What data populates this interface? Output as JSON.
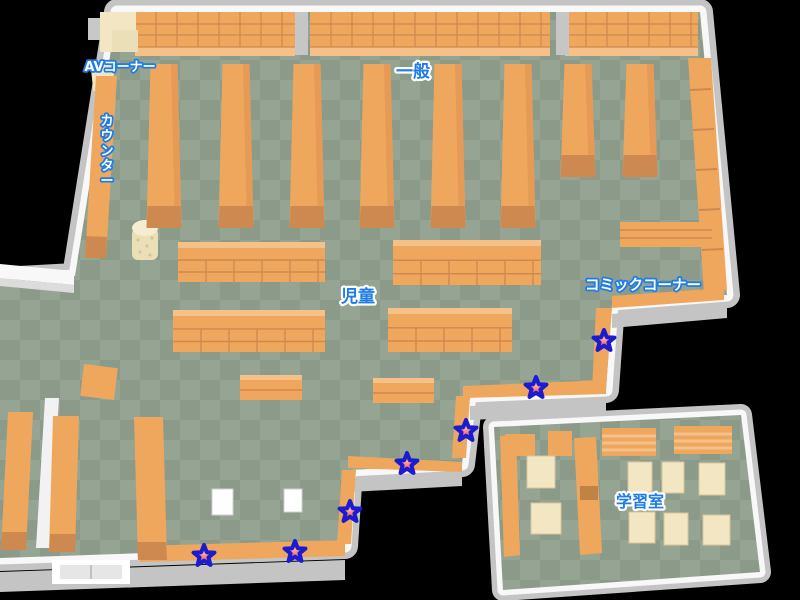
{
  "map": {
    "areas": {
      "av_corner": {
        "label": "AVコーナー"
      },
      "counter": {
        "label": "カウンター"
      },
      "general": {
        "label": "一般"
      },
      "children": {
        "label": "児童"
      },
      "comic_corner": {
        "label": "コミックコーナー"
      },
      "study_room": {
        "label": "学習室"
      }
    },
    "markers": [
      {
        "x": 604,
        "y": 341
      },
      {
        "x": 536,
        "y": 388
      },
      {
        "x": 466,
        "y": 431
      },
      {
        "x": 407,
        "y": 464
      },
      {
        "x": 350,
        "y": 512
      },
      {
        "x": 295,
        "y": 552
      },
      {
        "x": 204,
        "y": 556
      }
    ],
    "colors": {
      "floor_dark": "#8c9a8a",
      "floor_light": "#96a493",
      "shelf": "#efa75e",
      "shelf_dark": "#cd8950",
      "shelf_light": "#f6c189",
      "cream": "#f3e6c2",
      "wall": "#f8f8f8",
      "wall_shadow": "#c4c4c4",
      "label_blue": "#1e7ce6",
      "star_fill": "#ee3340",
      "star_center": "#ffb3ab",
      "star_outline": "#1b1bd0"
    }
  }
}
